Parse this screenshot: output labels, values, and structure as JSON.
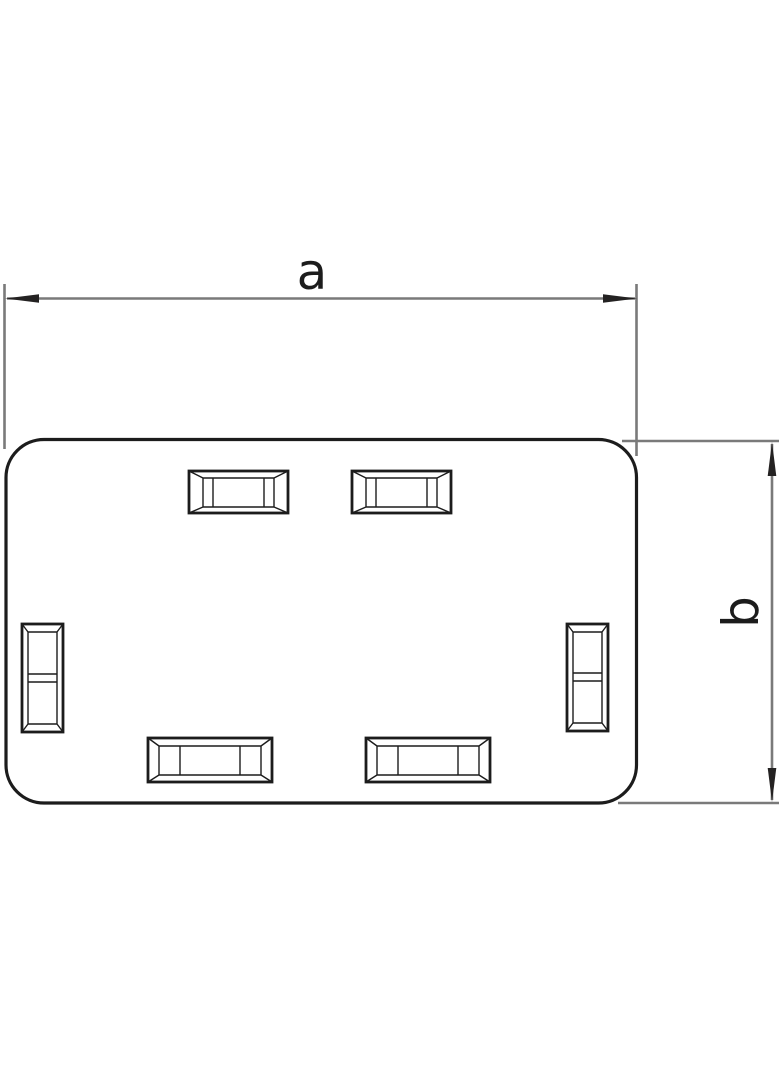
{
  "figure": {
    "background": "#ffffff",
    "stroke_colors": {
      "outline": "#1c1c1c",
      "dimension_line": "#7a7a7a",
      "arrow": "#242222",
      "text": "#1c1c1c"
    },
    "dimensions": [
      {
        "id": "a",
        "label": "a",
        "orientation": "horizontal"
      },
      {
        "id": "b",
        "label": "b",
        "orientation": "vertical"
      }
    ]
  }
}
